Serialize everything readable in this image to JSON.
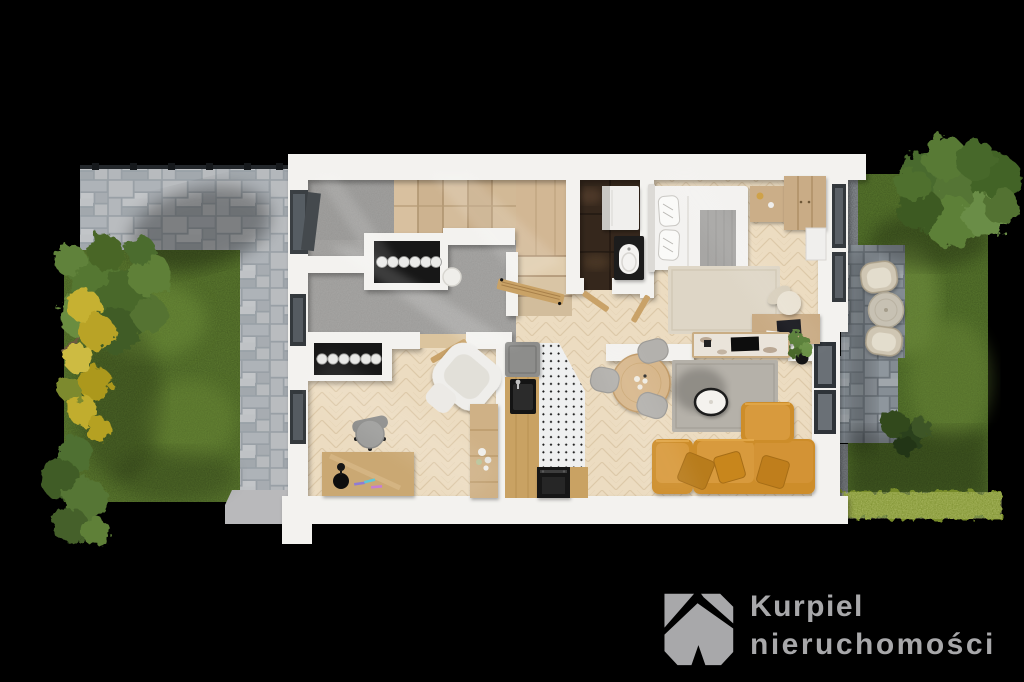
{
  "brand": {
    "name_line1": "Kurpiel",
    "name_line2": "nieruchomości",
    "text_color": "#a8a8aa",
    "mark_color": "#a8a8aa",
    "mark": "angular-k-monogram"
  },
  "scene": {
    "type": "top-down 3D floor plan render",
    "background": "#000000",
    "areas": [
      "driveway",
      "front-lawn",
      "entry-hall",
      "staircase",
      "hallway",
      "bathroom",
      "bedroom",
      "home-office",
      "kitchen",
      "dining-area",
      "living-room",
      "terrace",
      "garden",
      "hedge"
    ]
  },
  "palette": {
    "walls": "#f3f2ef",
    "wood_floor": "#ecdcc1",
    "concrete_floor": "#a6a5a3",
    "stair_wood": "#d3b994",
    "bathroom_tile": "#35271c",
    "kitchen_tile": "#eff0f0",
    "sofa": "#cd8d2b",
    "lawn": "#5e7d30",
    "driveway_pavers": "#b0b5b9",
    "terrace_pavers": "#8b939a"
  }
}
